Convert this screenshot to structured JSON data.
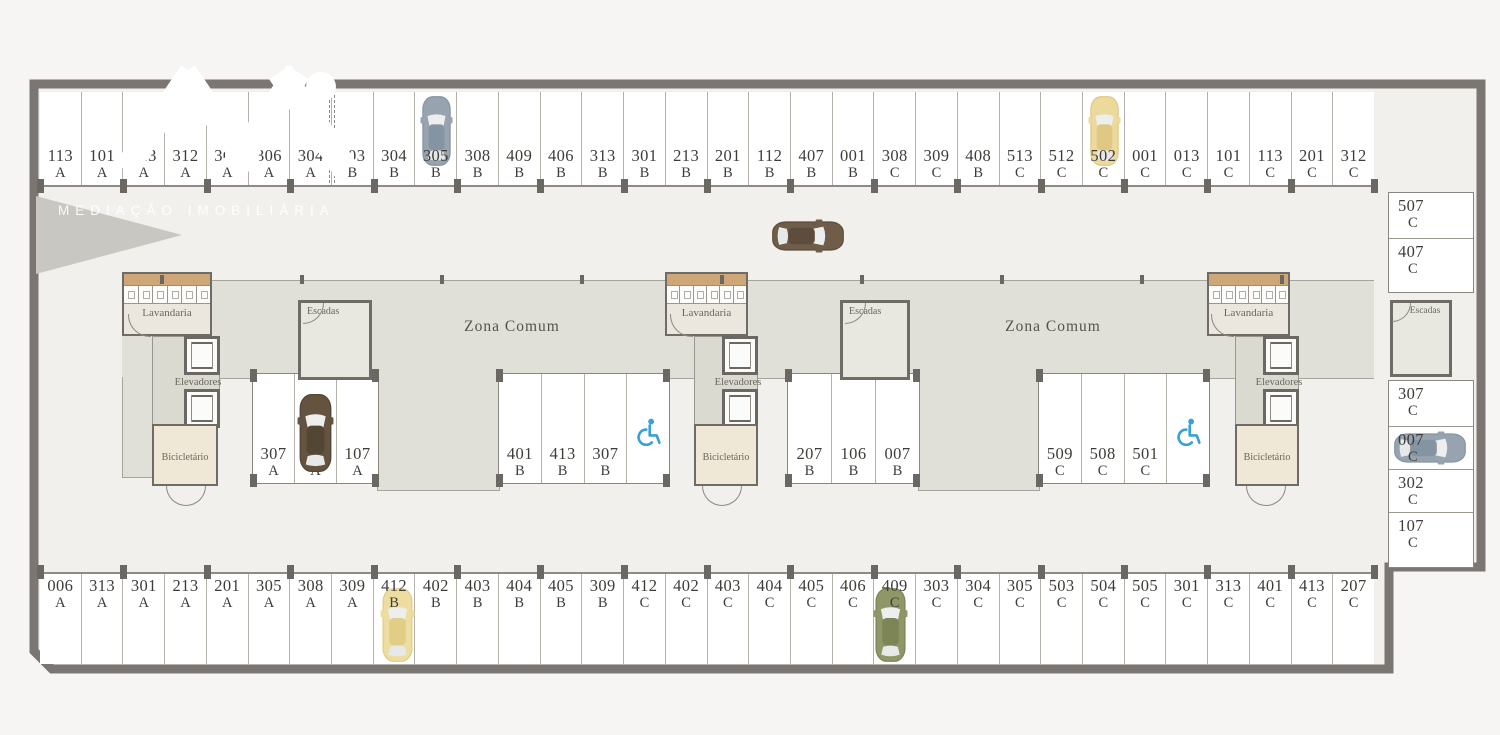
{
  "watermark": {
    "brand_text": "MEDIAÇÃO IMOBILIÁRIA"
  },
  "labels": {
    "zona_comum": "Zona Comum",
    "lavandaria": "Lavandaria",
    "escadas": "Escadas",
    "elevadores": "Elevadores",
    "bicicletario": "Bicicletário"
  },
  "top_row": [
    {
      "n": "113",
      "l": "A"
    },
    {
      "n": "101",
      "l": "A"
    },
    {
      "n": "013",
      "l": "A"
    },
    {
      "n": "312",
      "l": "A"
    },
    {
      "n": "302",
      "l": "A"
    },
    {
      "n": "306",
      "l": "A"
    },
    {
      "n": "304",
      "l": "A"
    },
    {
      "n": "303",
      "l": "B"
    },
    {
      "n": "304",
      "l": "B"
    },
    {
      "n": "305",
      "l": "B"
    },
    {
      "n": "308",
      "l": "B"
    },
    {
      "n": "409",
      "l": "B"
    },
    {
      "n": "406",
      "l": "B"
    },
    {
      "n": "313",
      "l": "B"
    },
    {
      "n": "301",
      "l": "B"
    },
    {
      "n": "213",
      "l": "B"
    },
    {
      "n": "201",
      "l": "B"
    },
    {
      "n": "112",
      "l": "B"
    },
    {
      "n": "407",
      "l": "B"
    },
    {
      "n": "001",
      "l": "B"
    },
    {
      "n": "308",
      "l": "C"
    },
    {
      "n": "309",
      "l": "C"
    },
    {
      "n": "408",
      "l": "B"
    },
    {
      "n": "513",
      "l": "C"
    },
    {
      "n": "512",
      "l": "C"
    },
    {
      "n": "502",
      "l": "C"
    },
    {
      "n": "001",
      "l": "C"
    },
    {
      "n": "013",
      "l": "C"
    },
    {
      "n": "101",
      "l": "C"
    },
    {
      "n": "113",
      "l": "C"
    },
    {
      "n": "201",
      "l": "C"
    },
    {
      "n": "312",
      "l": "C"
    }
  ],
  "bottom_row": [
    {
      "n": "006",
      "l": "A"
    },
    {
      "n": "313",
      "l": "A"
    },
    {
      "n": "301",
      "l": "A"
    },
    {
      "n": "213",
      "l": "A"
    },
    {
      "n": "201",
      "l": "A"
    },
    {
      "n": "305",
      "l": "A"
    },
    {
      "n": "308",
      "l": "A"
    },
    {
      "n": "309",
      "l": "A"
    },
    {
      "n": "412",
      "l": "B"
    },
    {
      "n": "402",
      "l": "B"
    },
    {
      "n": "403",
      "l": "B"
    },
    {
      "n": "404",
      "l": "B"
    },
    {
      "n": "405",
      "l": "B"
    },
    {
      "n": "309",
      "l": "B"
    },
    {
      "n": "412",
      "l": "C"
    },
    {
      "n": "402",
      "l": "C"
    },
    {
      "n": "403",
      "l": "C"
    },
    {
      "n": "404",
      "l": "C"
    },
    {
      "n": "405",
      "l": "C"
    },
    {
      "n": "406",
      "l": "C"
    },
    {
      "n": "409",
      "l": "C"
    },
    {
      "n": "303",
      "l": "C"
    },
    {
      "n": "304",
      "l": "C"
    },
    {
      "n": "305",
      "l": "C"
    },
    {
      "n": "503",
      "l": "C"
    },
    {
      "n": "504",
      "l": "C"
    },
    {
      "n": "505",
      "l": "C"
    },
    {
      "n": "301",
      "l": "C"
    },
    {
      "n": "313",
      "l": "C"
    },
    {
      "n": "401",
      "l": "C"
    },
    {
      "n": "413",
      "l": "C"
    },
    {
      "n": "207",
      "l": "C"
    }
  ],
  "right_column_upper": [
    {
      "n": "507",
      "l": "C"
    },
    {
      "n": "407",
      "l": "C"
    }
  ],
  "right_column_lower": [
    {
      "n": "307",
      "l": "C"
    },
    {
      "n": "007",
      "l": "C"
    },
    {
      "n": "302",
      "l": "C"
    },
    {
      "n": "107",
      "l": "C"
    }
  ],
  "islands": {
    "left": [
      {
        "n": "307",
        "l": "A"
      },
      {
        "n": "207",
        "l": "A"
      },
      {
        "n": "107",
        "l": "A"
      }
    ],
    "center": [
      {
        "n": "401",
        "l": "B"
      },
      {
        "n": "413",
        "l": "B"
      },
      {
        "n": "307",
        "l": "B"
      }
    ],
    "mid": [
      {
        "n": "207",
        "l": "B"
      },
      {
        "n": "106",
        "l": "B"
      },
      {
        "n": "007",
        "l": "B"
      }
    ],
    "right": [
      {
        "n": "509",
        "l": "C"
      },
      {
        "n": "508",
        "l": "C"
      },
      {
        "n": "501",
        "l": "C"
      }
    ]
  },
  "accessible_icon_color": "#3aa0da",
  "cars": [
    {
      "name": "car-gray-top",
      "body": "#97a3ae",
      "roof": "#8494a3",
      "cx": 436,
      "cy": 131,
      "rot": 0,
      "len": 74,
      "wid": 33
    },
    {
      "name": "car-yellow-top",
      "body": "#ecd99c",
      "roof": "#dfc784",
      "cx": 1104,
      "cy": 131,
      "rot": 0,
      "len": 74,
      "wid": 33
    },
    {
      "name": "car-brown-middle",
      "body": "#6f5c49",
      "roof": "#5e4d3c",
      "cx": 808,
      "cy": 236,
      "rot": 90,
      "len": 76,
      "wid": 34
    },
    {
      "name": "car-brown-island",
      "body": "#64543f",
      "roof": "#544635",
      "cx": 315,
      "cy": 433,
      "rot": 0,
      "len": 92,
      "wid": 37
    },
    {
      "name": "car-yellow-bottom",
      "body": "#eedda0",
      "roof": "#e2cd86",
      "cx": 397,
      "cy": 625,
      "rot": 0,
      "len": 82,
      "wid": 35
    },
    {
      "name": "car-green-bottom",
      "body": "#8f9668",
      "roof": "#7d8556",
      "cx": 890,
      "cy": 625,
      "rot": 0,
      "len": 82,
      "wid": 35
    },
    {
      "name": "car-gray-right",
      "body": "#97a3ae",
      "roof": "#8494a3",
      "cx": 1430,
      "cy": 448,
      "rot": 90,
      "len": 76,
      "wid": 34
    }
  ],
  "colors": {
    "wall": "#7b7672",
    "interior": "#f1f0ed",
    "zona": "#e1e0d8",
    "stall_line": "#b4b1ab",
    "room_cream": "#ebe6de",
    "wood_strip": "#cfa678",
    "bike_room": "#efe8d7",
    "triangle": "#c9c7c2"
  }
}
